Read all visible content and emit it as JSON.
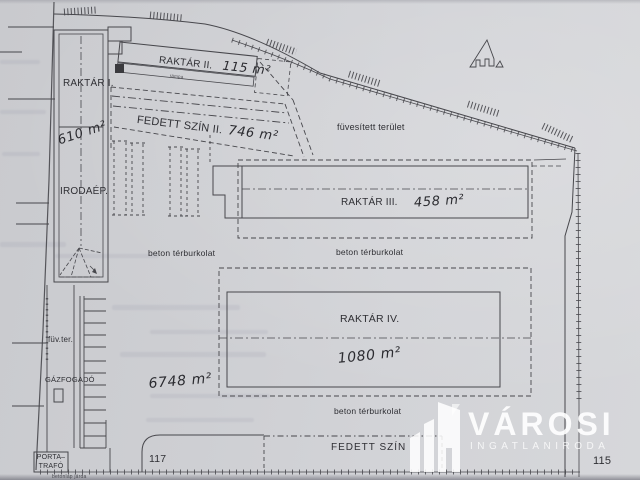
{
  "plan": {
    "labels": {
      "raktar1": "RAKTÁR I.",
      "raktar1_area": "610 m²",
      "irodaep": "IRODAÉP.",
      "raktar2": "RAKTÁR II.",
      "raktar2_area": "115 m²",
      "ramp": "rámpa",
      "fedett_szin2": "FEDETT SZÍN II.",
      "fedett_szin2_area": "746 m²",
      "fuvesitett_terulet": "füvesített terület",
      "raktar3": "RAKTÁR III.",
      "raktar3_area": "458 m²",
      "beton_1": "beton térburkolat",
      "beton_2": "beton térburkolat",
      "beton_3": "beton térburkolat",
      "raktar4": "RAKTÁR IV.",
      "raktar4_area": "1080 m²",
      "fuv_ter": "füv.ter.",
      "gazfogado": "GÁZFOGADÓ",
      "porta_line1": "PORTA–",
      "porta_line2": "TRAFÓ",
      "total_area": "6748 m²",
      "parcel_left": "117",
      "parcel_right": "115",
      "fedett_szin_bottom": "FEDETT SZÍN",
      "betonlap_jarda": "betonlap járda"
    },
    "colors": {
      "paper": "#cecfd3",
      "line": "#47474c",
      "ink": "#2f2f34",
      "watermark": "#ffffff"
    }
  },
  "watermark": {
    "brand": "VÁROSI",
    "subtitle": "INGATLANIRODA"
  }
}
